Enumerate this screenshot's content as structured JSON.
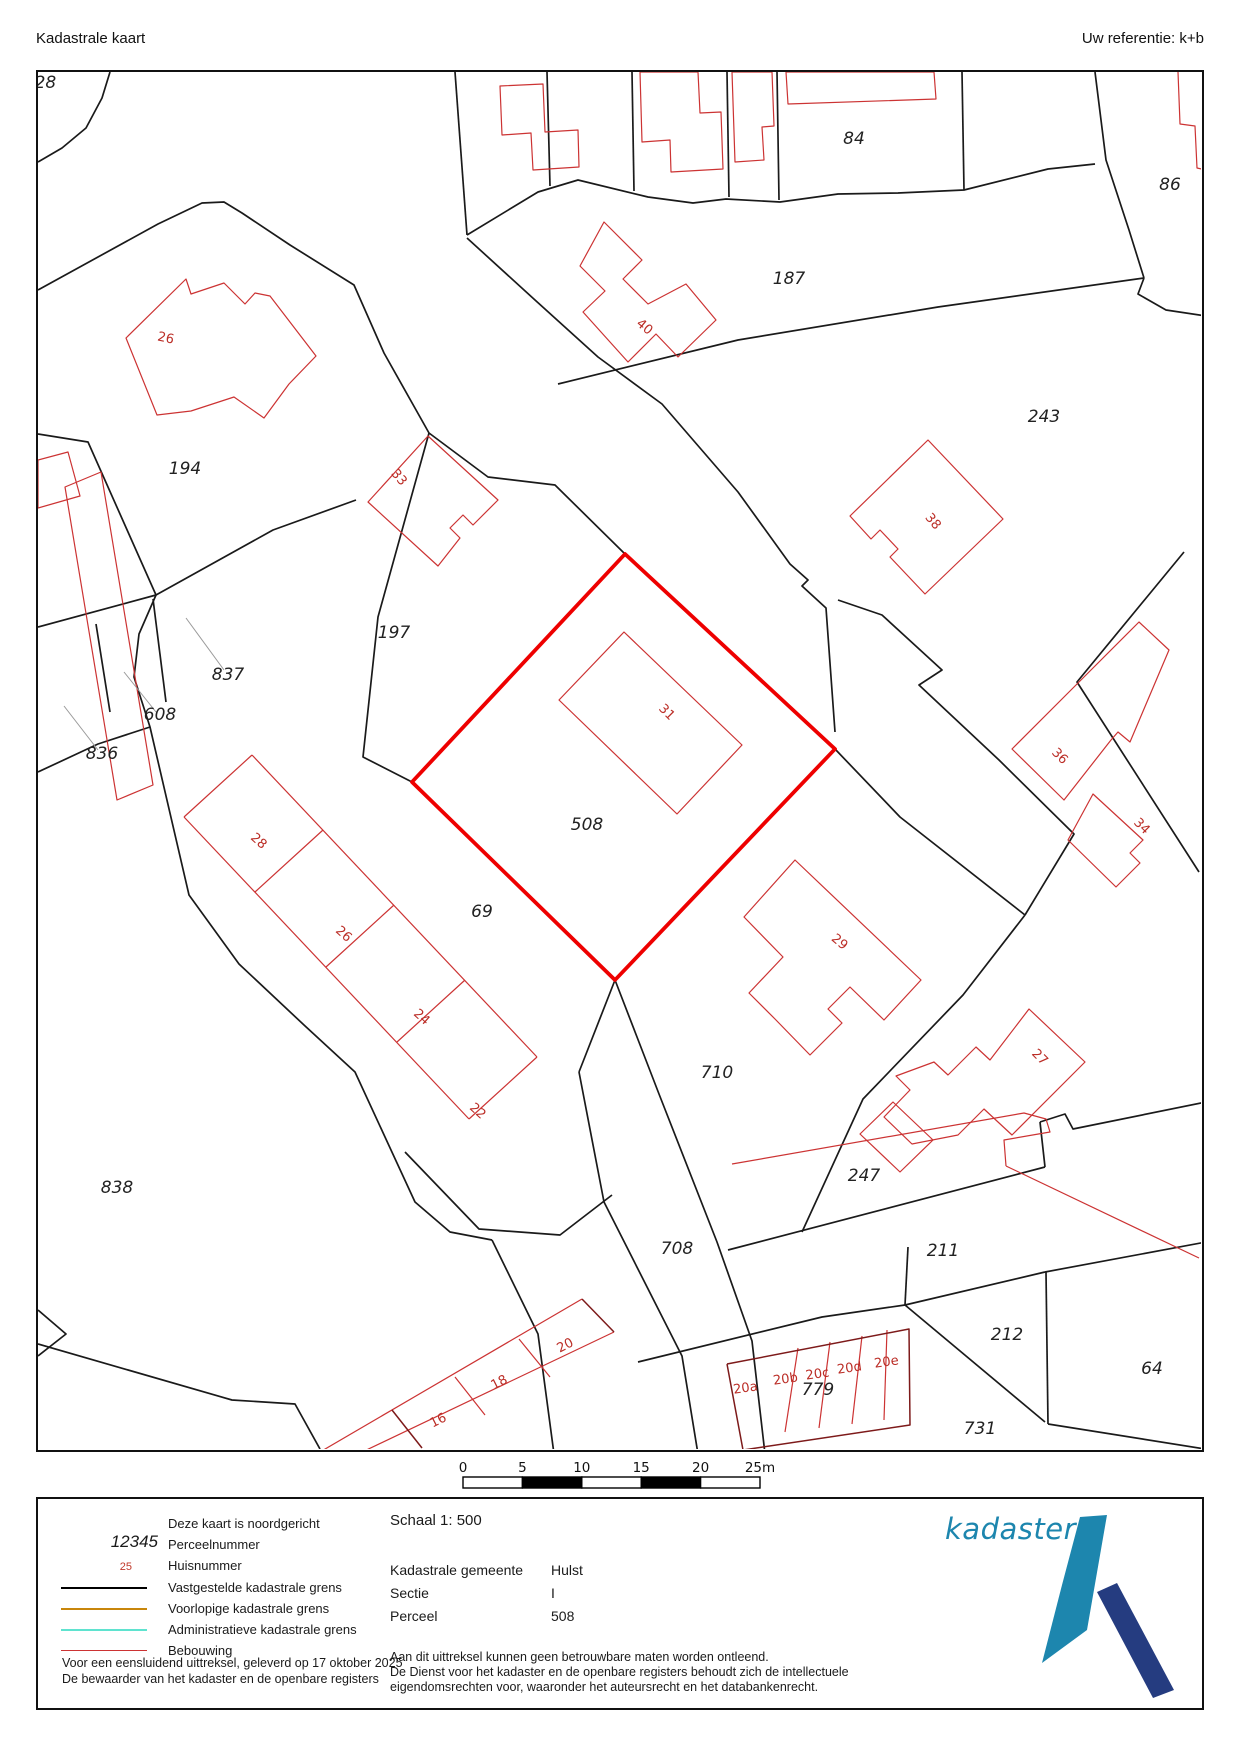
{
  "header": {
    "title": "Kadastrale kaart",
    "reference": "Uw referentie: k+b"
  },
  "map": {
    "colors": {
      "boundary": "#1a1a1a",
      "building": "#cc3333",
      "building_dark": "#7d1a1a",
      "selected": "#ee0000",
      "leader": "#9a9a9a"
    },
    "selected_parcel": [
      587,
      482,
      797,
      677,
      577,
      908,
      374,
      710
    ],
    "boundaries": [
      [
        72,
        0,
        64,
        26,
        48,
        56,
        24,
        76,
        0,
        90
      ],
      [
        0,
        218,
        120,
        152,
        164,
        131,
        186,
        130,
        204,
        141,
        252,
        173,
        316,
        213,
        346,
        281,
        391,
        361
      ],
      [
        391,
        361,
        450,
        405,
        517,
        413,
        587,
        482
      ],
      [
        391,
        361,
        340,
        545,
        325,
        685,
        374,
        710
      ],
      [
        417,
        0,
        429,
        163
      ],
      [
        429,
        163,
        500,
        120,
        540,
        108,
        610,
        125,
        655,
        131,
        688,
        127,
        742,
        130,
        800,
        122,
        860,
        121,
        926,
        118,
        1010,
        97,
        1057,
        92
      ],
      [
        509,
        0,
        512,
        114
      ],
      [
        594,
        0,
        596,
        119
      ],
      [
        689,
        0,
        691,
        125
      ],
      [
        739,
        0,
        741,
        128
      ],
      [
        924,
        0,
        926,
        118
      ],
      [
        1057,
        0,
        1068,
        88,
        1091,
        158,
        1106,
        206
      ],
      [
        429,
        166,
        497,
        228,
        560,
        285,
        624,
        332,
        700,
        420,
        752,
        492,
        770,
        508,
        764,
        514,
        788,
        536,
        797,
        660
      ],
      [
        520,
        312,
        700,
        268,
        900,
        235,
        1106,
        206
      ],
      [
        1106,
        206,
        1100,
        222,
        1128,
        238,
        1168,
        244
      ],
      [
        800,
        528,
        844,
        543,
        904,
        598,
        881,
        613,
        961,
        688,
        1036,
        762,
        987,
        843
      ],
      [
        1146,
        480,
        1039,
        610,
        1161,
        800
      ],
      [
        797,
        677,
        862,
        745,
        987,
        843
      ],
      [
        987,
        843,
        925,
        923,
        825,
        1027,
        764,
        1160
      ],
      [
        0,
        555,
        118,
        523,
        235,
        458,
        318,
        428
      ],
      [
        0,
        700,
        60,
        672,
        112,
        655
      ],
      [
        115,
        527,
        128,
        630
      ],
      [
        58,
        552,
        72,
        640
      ],
      [
        118,
        523,
        101,
        562,
        96,
        605,
        112,
        655,
        151,
        823,
        201,
        892,
        266,
        953,
        317,
        1000,
        377,
        1130,
        412,
        1160,
        454,
        1168
      ],
      [
        454,
        1168,
        500,
        1262,
        516,
        1382
      ],
      [
        541,
        1000,
        577,
        908
      ],
      [
        541,
        1000,
        566,
        1130,
        644,
        1284,
        660,
        1382
      ],
      [
        577,
        908,
        621,
        1022,
        679,
        1170,
        714,
        1269,
        727,
        1382
      ],
      [
        367,
        1080,
        441,
        1157,
        522,
        1163,
        574,
        1123
      ],
      [
        690,
        1178,
        1007,
        1095
      ],
      [
        1007,
        1095,
        1002,
        1050
      ],
      [
        1002,
        1050,
        1027,
        1042,
        1035,
        1057,
        1168,
        1030
      ],
      [
        600,
        1290,
        784,
        1245,
        867,
        1233
      ],
      [
        867,
        1233,
        1007,
        1350
      ],
      [
        867,
        1233,
        1007,
        1200
      ],
      [
        1008,
        1200,
        1010,
        1352
      ],
      [
        1010,
        1352,
        1167,
        1377
      ],
      [
        1007,
        1200,
        1168,
        1170
      ],
      [
        870,
        1175,
        867,
        1233
      ],
      [
        0,
        1272,
        194,
        1328,
        257,
        1332,
        282,
        1377
      ],
      [
        0,
        1238,
        28,
        1262,
        0,
        1284
      ],
      [
        0,
        362,
        50,
        370,
        118,
        523
      ],
      [
        587,
        482,
        374,
        710
      ],
      [
        374,
        710,
        577,
        908
      ]
    ],
    "buildings_closed": [
      [
        88,
        266,
        148,
        207,
        153,
        222,
        186,
        211,
        207,
        232,
        217,
        221,
        232,
        224,
        278,
        284,
        251,
        312,
        226,
        346,
        196,
        325,
        153,
        339,
        119,
        343
      ],
      [
        330,
        430,
        390,
        364,
        460,
        428,
        435,
        453,
        425,
        443,
        412,
        456,
        422,
        466,
        400,
        494
      ],
      [
        566,
        150,
        604,
        188,
        585,
        207,
        610,
        232,
        648,
        212,
        678,
        248,
        640,
        285,
        618,
        262,
        590,
        290,
        545,
        240,
        567,
        219,
        542,
        194
      ],
      [
        890,
        368,
        965,
        447,
        887,
        522,
        852,
        485,
        860,
        477,
        842,
        458,
        833,
        467,
        812,
        444
      ],
      [
        586,
        560,
        521,
        628,
        639,
        742,
        704,
        673
      ],
      [
        757,
        788,
        883,
        908,
        846,
        948,
        812,
        915,
        790,
        937,
        804,
        951,
        772,
        983,
        737,
        947,
        711,
        921,
        745,
        885,
        706,
        845
      ],
      [
        991,
        937,
        1047,
        990,
        974,
        1063,
        946,
        1037,
        920,
        1063,
        874,
        1072,
        846,
        1045,
        872,
        1018,
        858,
        1004,
        896,
        990,
        910,
        1003,
        938,
        975,
        952,
        988
      ],
      [
        855,
        1030,
        895,
        1068,
        862,
        1100,
        822,
        1062
      ],
      [
        462,
        14,
        505,
        12,
        507,
        60,
        540,
        58,
        541,
        95,
        495,
        98,
        493,
        61,
        464,
        63
      ],
      [
        602,
        0,
        604,
        70,
        632,
        68,
        633,
        100,
        685,
        97,
        683,
        40,
        662,
        41,
        660,
        0
      ],
      [
        694,
        0,
        697,
        90,
        726,
        88,
        724,
        55,
        736,
        54,
        734,
        0
      ],
      [
        748,
        0,
        750,
        32,
        898,
        27,
        896,
        0
      ],
      [
        27,
        415,
        63,
        400,
        115,
        713,
        79,
        728
      ],
      [
        0,
        388,
        30,
        380,
        42,
        424,
        0,
        436
      ],
      [
        1039,
        612,
        1101,
        550,
        1131,
        578,
        1092,
        670,
        1080,
        660,
        1073,
        668,
        1026,
        728,
        974,
        677
      ],
      [
        1055,
        722,
        1105,
        768,
        1092,
        781,
        1102,
        791,
        1078,
        815,
        1030,
        768
      ]
    ],
    "buildings_open": [
      [
        1140,
        0,
        1142,
        52,
        1157,
        54,
        1159,
        96,
        1168,
        98
      ],
      [
        214,
        683,
        499,
        985
      ],
      [
        146,
        745,
        431,
        1047
      ],
      [
        214,
        683,
        146,
        745
      ],
      [
        499,
        985,
        431,
        1047
      ],
      [
        285,
        758,
        217,
        820
      ],
      [
        356,
        833,
        288,
        895
      ],
      [
        427,
        908,
        359,
        970
      ],
      [
        544,
        1227,
        282,
        1380
      ],
      [
        576,
        1260,
        320,
        1382
      ],
      [
        481,
        1267,
        512,
        1305
      ],
      [
        417,
        1305,
        447,
        1343
      ],
      [
        694,
        1092,
        986,
        1041,
        1008,
        1047,
        1012,
        1060,
        966,
        1068,
        968,
        1094
      ],
      [
        968,
        1094,
        1161,
        1186
      ],
      [
        760,
        1276,
        747,
        1360
      ],
      [
        792,
        1270,
        781,
        1356
      ],
      [
        824,
        1264,
        814,
        1352
      ],
      [
        849,
        1258,
        846,
        1348
      ]
    ],
    "buildings_dark": [
      [
        544,
        1227,
        576,
        1260
      ],
      [
        354,
        1338,
        384,
        1376
      ],
      [
        689,
        1292,
        871,
        1257,
        872,
        1353,
        705,
        1378,
        689,
        1292
      ]
    ],
    "leader_lines": [
      [
        186,
        598,
        148,
        546
      ],
      [
        118,
        640,
        86,
        600
      ],
      [
        60,
        678,
        26,
        634
      ]
    ],
    "parcel_labels": [
      {
        "t": "928",
        "x": 2,
        "y": 16
      },
      {
        "t": "194",
        "x": 147,
        "y": 402
      },
      {
        "t": "197",
        "x": 356,
        "y": 566
      },
      {
        "t": "837",
        "x": 190,
        "y": 608
      },
      {
        "t": "608",
        "x": 122,
        "y": 648
      },
      {
        "t": "836",
        "x": 64,
        "y": 687
      },
      {
        "t": "838",
        "x": 79,
        "y": 1121
      },
      {
        "t": "69",
        "x": 444,
        "y": 845
      },
      {
        "t": "508",
        "x": 549,
        "y": 758
      },
      {
        "t": "710",
        "x": 679,
        "y": 1006
      },
      {
        "t": "708",
        "x": 639,
        "y": 1182
      },
      {
        "t": "247",
        "x": 826,
        "y": 1109
      },
      {
        "t": "211",
        "x": 905,
        "y": 1184
      },
      {
        "t": "212",
        "x": 969,
        "y": 1268
      },
      {
        "t": "64",
        "x": 1114,
        "y": 1302
      },
      {
        "t": "731",
        "x": 942,
        "y": 1362
      },
      {
        "t": "779",
        "x": 780,
        "y": 1323
      },
      {
        "t": "84",
        "x": 816,
        "y": 72
      },
      {
        "t": "86",
        "x": 1132,
        "y": 118
      },
      {
        "t": "187",
        "x": 751,
        "y": 212
      },
      {
        "t": "243",
        "x": 1006,
        "y": 350
      }
    ],
    "house_labels": [
      {
        "t": "26",
        "x": 127,
        "y": 270,
        "r": 12
      },
      {
        "t": "33",
        "x": 358,
        "y": 408,
        "r": 50
      },
      {
        "t": "40",
        "x": 604,
        "y": 258,
        "r": 40
      },
      {
        "t": "38",
        "x": 892,
        "y": 452,
        "r": 50
      },
      {
        "t": "31",
        "x": 626,
        "y": 643,
        "r": 45
      },
      {
        "t": "36",
        "x": 1019,
        "y": 687,
        "r": 45
      },
      {
        "t": "34",
        "x": 1101,
        "y": 757,
        "r": 45
      },
      {
        "t": "28",
        "x": 218,
        "y": 772,
        "r": 42
      },
      {
        "t": "26",
        "x": 303,
        "y": 865,
        "r": 42
      },
      {
        "t": "24",
        "x": 381,
        "y": 948,
        "r": 42
      },
      {
        "t": "22",
        "x": 437,
        "y": 1042,
        "r": 42
      },
      {
        "t": "29",
        "x": 799,
        "y": 873,
        "r": 40
      },
      {
        "t": "27",
        "x": 999,
        "y": 988,
        "r": 45
      },
      {
        "t": "16",
        "x": 402,
        "y": 1352,
        "r": -27
      },
      {
        "t": "18",
        "x": 463,
        "y": 1314,
        "r": -27
      },
      {
        "t": "20",
        "x": 529,
        "y": 1277,
        "r": -27
      },
      {
        "t": "20a",
        "x": 708,
        "y": 1320,
        "r": -8
      },
      {
        "t": "20b",
        "x": 748,
        "y": 1311,
        "r": -8
      },
      {
        "t": "20c",
        "x": 780,
        "y": 1306,
        "r": -8
      },
      {
        "t": "20d",
        "x": 812,
        "y": 1300,
        "r": -8
      },
      {
        "t": "20e",
        "x": 849,
        "y": 1294,
        "r": -8
      }
    ]
  },
  "scalebar": {
    "unit_labels": [
      "0",
      "5",
      "10",
      "15",
      "20",
      "25m"
    ],
    "bar_x": 463,
    "label_y": 14,
    "bar_y": 19,
    "seg_w": 59.4,
    "bar_h": 11,
    "fills": [
      "#ffffff",
      "#000000",
      "#ffffff",
      "#000000",
      "#ffffff"
    ]
  },
  "legend": {
    "north_note": "Deze kaart is noordgericht",
    "perceel_sample": "12345",
    "perceel_label": "Perceelnummer",
    "huis_sample": "25",
    "huis_label": "Huisnummer",
    "lines": [
      {
        "label": "Vastgestelde kadastrale grens",
        "color": "#000000",
        "w": 2.5
      },
      {
        "label": "Voorlopige kadastrale grens",
        "color": "#c8860b",
        "w": 2.5
      },
      {
        "label": "Administratieve kadastrale grens",
        "color": "#5fe3cf",
        "w": 2.5
      },
      {
        "label": "Bebouwing",
        "color": "#cc3333",
        "w": 1.4
      }
    ],
    "footer1": "Voor een eensluidend uittreksel, geleverd op 17 oktober 2025",
    "footer2": "De bewaarder van het kadaster en de openbare registers",
    "schaal": "Schaal 1: 500",
    "fields": [
      {
        "k": "Kadastrale gemeente",
        "v": "Hulst"
      },
      {
        "k": "Sectie",
        "v": "I"
      },
      {
        "k": "Perceel",
        "v": "508"
      }
    ],
    "disclaimer": [
      "Aan dit uittreksel kunnen geen betrouwbare maten worden ontleend.",
      "De Dienst voor het kadaster en de openbare registers behoudt zich de intellectuele",
      "eigendomsrechten voor, waaronder het auteursrecht en het databankenrecht."
    ],
    "logo_text": "kadaster",
    "logo_colors": {
      "teal": "#1d86ae",
      "navy": "#253c80"
    }
  }
}
